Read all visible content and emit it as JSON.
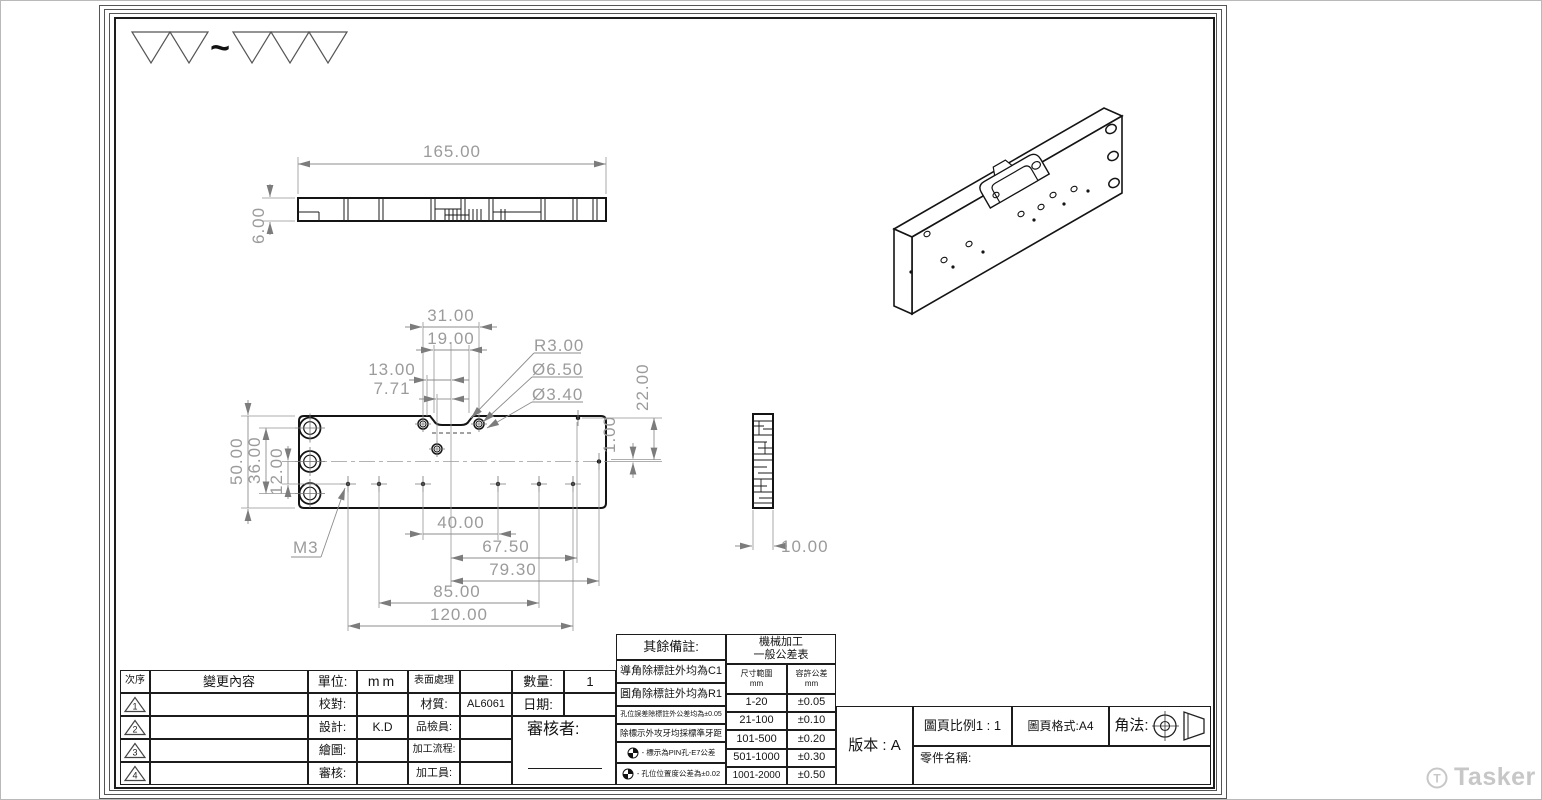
{
  "surface_finish": {
    "tilde": "~"
  },
  "dims": {
    "top_length": "165.00",
    "top_thickness": "6.00",
    "w31": "31.00",
    "w19": "19.00",
    "w13": "13.00",
    "w771": "7.71",
    "r3": "R3.00",
    "d650": "Ø6.50",
    "d340": "Ø3.40",
    "h50": "50.00",
    "h36": "36.00",
    "h12": "12.00",
    "h22": "22.00",
    "h1": "1.00",
    "b40": "40.00",
    "b675": "67.50",
    "b793": "79.30",
    "b85": "85.00",
    "b120": "120.00",
    "m3": "M3",
    "side_width": "10.00"
  },
  "revision": {
    "col_seq": "次序",
    "col_change": "變更內容",
    "marks": [
      "1",
      "2",
      "3",
      "4"
    ]
  },
  "fields": {
    "unit_label": "單位:",
    "unit_value": "mm",
    "surface_label": "表面處理",
    "surface_value": "",
    "check_label": "校對:",
    "check_value": "",
    "material_label": "材質:",
    "material_value": "AL6061",
    "design_label": "設計:",
    "design_value": "K.D",
    "inspector_label": "品檢員:",
    "inspector_value": "",
    "draw_label": "繪圖:",
    "draw_value": "",
    "process_label": "加工流程:",
    "process_value": "",
    "review_label": "審核:",
    "review_value": "",
    "operator_label": "加工員:",
    "operator_value": "",
    "qty_label": "數量:",
    "qty_value": "1",
    "date_label": "日期:",
    "date_value": "",
    "approver_label": "審核者:"
  },
  "notes": {
    "title": "其餘備註:",
    "items": [
      "導角除標註外均為C1",
      "圓角除標註外均為R1",
      "孔位誤差除標註外公差均為±0.05",
      "除標示外攻牙均採標準牙距",
      "- 標示為PIN孔-E7公差",
      "- 孔位位置度公差為±0.02"
    ]
  },
  "tolerance": {
    "title_line1": "機械加工",
    "title_line2": "一般公差表",
    "col_range": "尺寸範圍",
    "col_tol": "容許公差",
    "unit": "mm",
    "rows": [
      {
        "range": "1-20",
        "tol": "±0.05"
      },
      {
        "range": "21-100",
        "tol": "±0.10"
      },
      {
        "range": "101-500",
        "tol": "±0.20"
      },
      {
        "range": "501-1000",
        "tol": "±0.30"
      },
      {
        "range": "1001-2000",
        "tol": "±0.50"
      }
    ]
  },
  "info": {
    "version": "版本 : A",
    "scale": "圖頁比例1 : 1",
    "format": "圖頁格式:A4",
    "projection_label": "角法:",
    "part_name_label": "零件名稱:"
  },
  "watermark": {
    "brand": "Tasker",
    "logo_letter": "T"
  }
}
